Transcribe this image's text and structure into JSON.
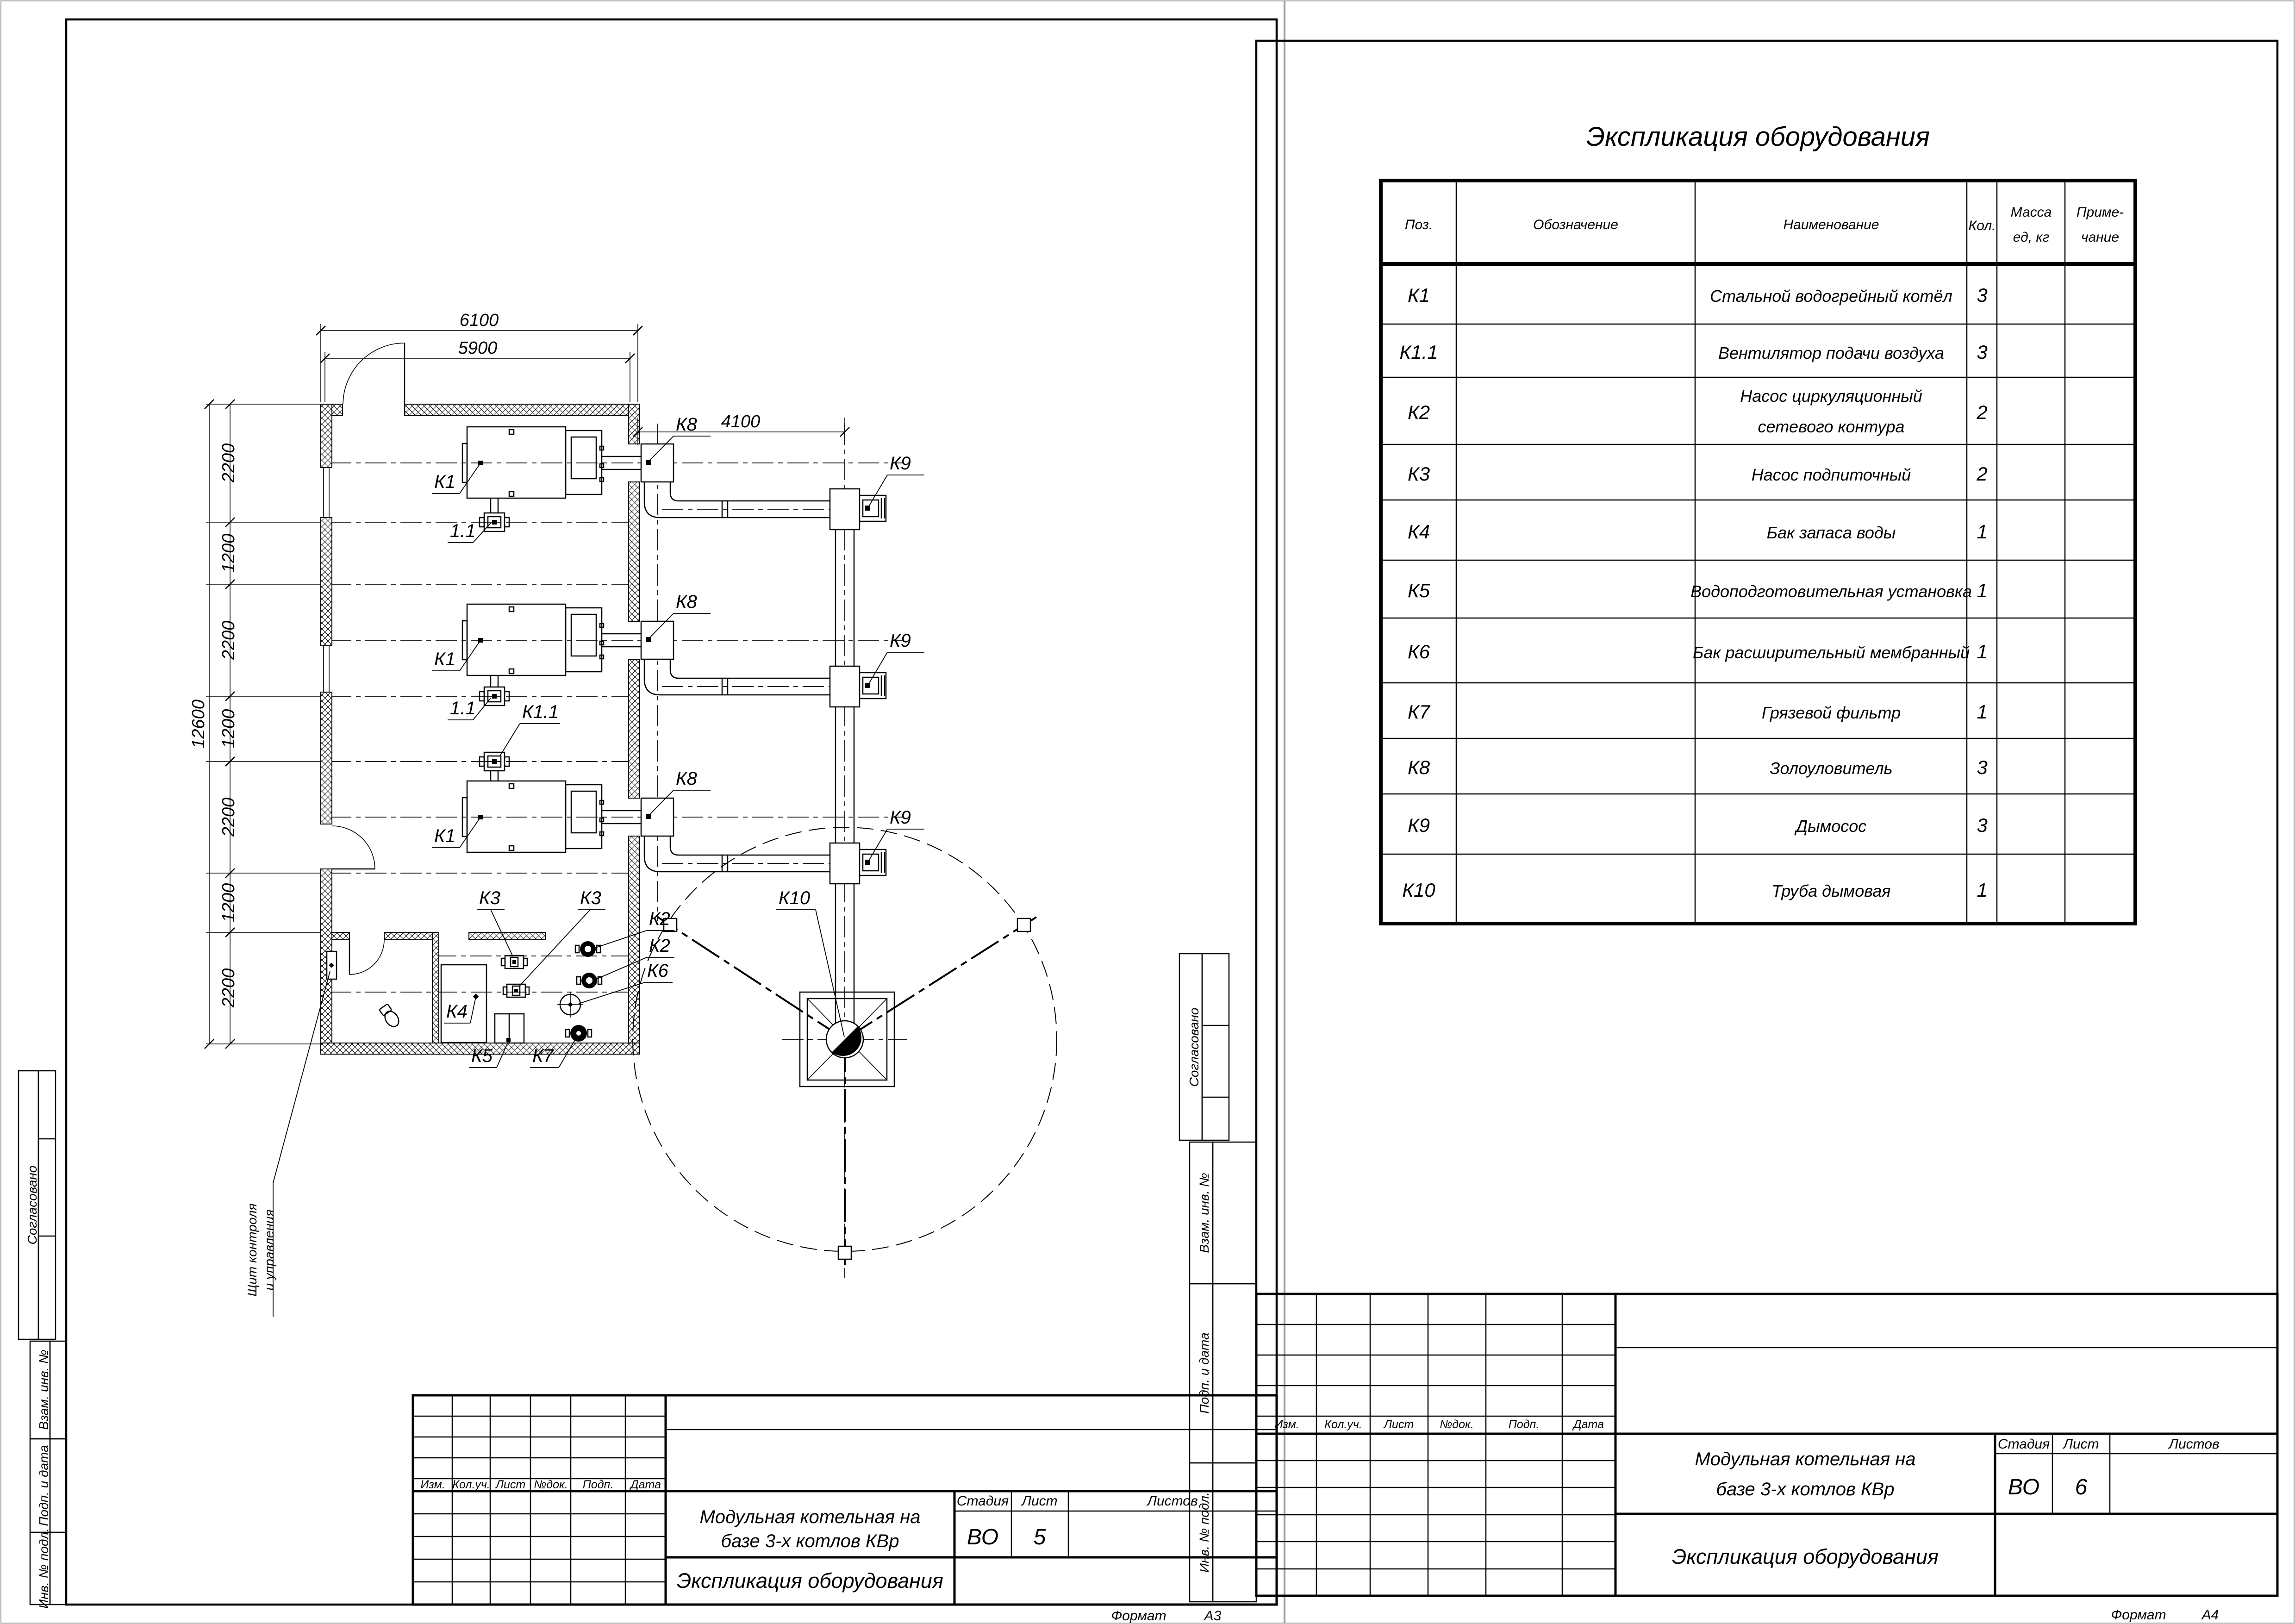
{
  "common": {
    "stamp": {
      "soglasovano": "Согласовано",
      "vzam_inv": "Взам. инв. №",
      "podp_data": "Подп. и дата",
      "inv_podl": "Инв. № подл."
    },
    "titleblock": {
      "izm": "Изм.",
      "koluch": "Кол.уч.",
      "list": "Лист",
      "ndok": "№док.",
      "podp": "Подп.",
      "data": "Дата",
      "stadia": "Стадия",
      "listov": "Листов",
      "stage": "ВО",
      "project_line1": "Модульная котельная на",
      "project_line2": "базе 3-х котлов КВр",
      "doc_title": "Экспликация оборудования",
      "format_label": "Формат"
    }
  },
  "left_sheet": {
    "sheet_no": "5",
    "format": "А3",
    "plan": {
      "dims": {
        "w_outer": "6100",
        "w_inner": "5900",
        "flue": "4100",
        "h_total": "12600",
        "bay": "2200",
        "gap": "1200"
      },
      "labels": {
        "k1": "К1",
        "fan": "1.1",
        "k11": "К1.1",
        "k2": "К2",
        "k3": "К3",
        "k4": "К4",
        "k5": "К5",
        "k6": "К6",
        "k7": "К7",
        "k8": "К8",
        "k9": "К9",
        "k10": "К10"
      },
      "notes": {
        "panel_line1": "Щит контроля",
        "panel_line2": "и управления"
      }
    }
  },
  "right_sheet": {
    "sheet_no": "6",
    "format": "А4",
    "table": {
      "title": "Экспликация оборудования",
      "headers": {
        "pos": "Поз.",
        "designation": "Обозначение",
        "name": "Наименование",
        "qty": "Кол.",
        "mass_line1": "Масса",
        "mass_line2": "ед, кг",
        "note_line1": "Приме-",
        "note_line2": "чание"
      },
      "rows": [
        {
          "pos": "К1",
          "name": "Стальной водогрейный котёл",
          "qty": "3"
        },
        {
          "pos": "К1.1",
          "name": "Вентилятор подачи воздуха",
          "qty": "3"
        },
        {
          "pos": "К2",
          "name": "Насос циркуляционный",
          "name2": "сетевого контура",
          "qty": "2"
        },
        {
          "pos": "К3",
          "name": "Насос подпиточный",
          "qty": "2"
        },
        {
          "pos": "К4",
          "name": "Бак запаса воды",
          "qty": "1"
        },
        {
          "pos": "К5",
          "name": "Водоподготовительная установка",
          "qty": "1"
        },
        {
          "pos": "К6",
          "name": "Бак расширительный мембранный",
          "qty": "1"
        },
        {
          "pos": "К7",
          "name": "Грязевой фильтр",
          "qty": "1"
        },
        {
          "pos": "К8",
          "name": "Золоуловитель",
          "qty": "3"
        },
        {
          "pos": "К9",
          "name": "Дымосос",
          "qty": "3"
        },
        {
          "pos": "К10",
          "name": "Труба дымовая",
          "qty": "1"
        }
      ]
    }
  }
}
